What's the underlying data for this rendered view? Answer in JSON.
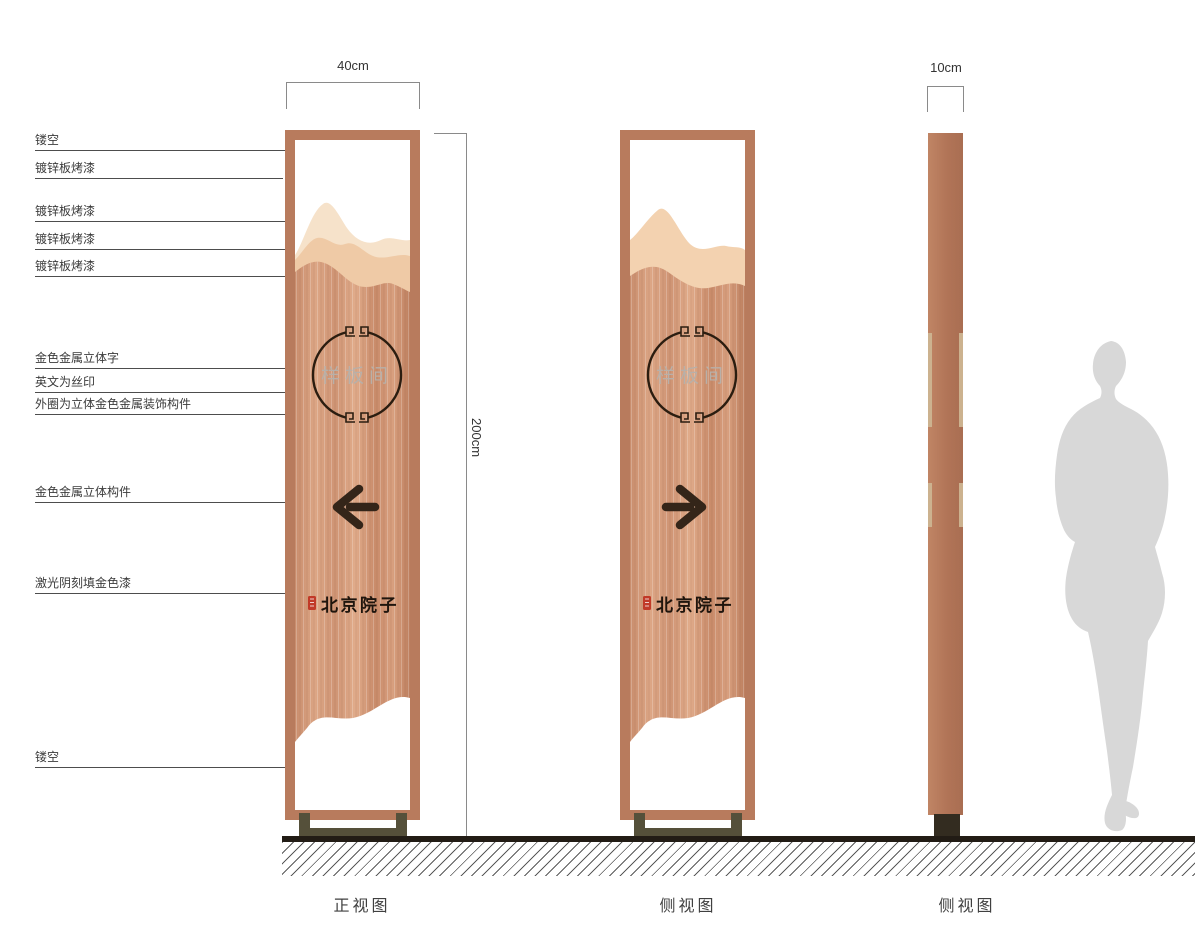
{
  "dimensions": {
    "front_width": "40cm",
    "height": "200cm",
    "side_depth": "10cm"
  },
  "callouts": [
    {
      "label": "镂空"
    },
    {
      "label": "镀锌板烤漆"
    },
    {
      "label": "镀锌板烤漆"
    },
    {
      "label": "镀锌板烤漆"
    },
    {
      "label": "镀锌板烤漆"
    },
    {
      "label": "金色金属立体字"
    },
    {
      "label": "英文为丝印"
    },
    {
      "label": "外圈为立体金色金属装饰构件"
    },
    {
      "label": "金色金属立体构件"
    },
    {
      "label": "激光阴刻填金色漆"
    },
    {
      "label": "镂空"
    }
  ],
  "sign": {
    "plate_text": "样板间",
    "brand_text": "北京院子"
  },
  "views": [
    {
      "label": "正视图"
    },
    {
      "label": "侧视图"
    },
    {
      "label": "侧视图"
    }
  ],
  "icons": {
    "front_arrow": "arrow-left",
    "side_arrow": "arrow-right"
  },
  "colors": {
    "frame_copper": "#b87b5d",
    "panel_copper": "#cf9475",
    "mountain_light": "#f6e2ca",
    "mountain_mid": "#efcaa6",
    "single_mountain": "#f3d2b0",
    "accent_dark": "#342519",
    "plate_text_silver": "#b8b0a9",
    "seal_red": "#c13a28",
    "base_olive": "#55503a",
    "silhouette_gray": "#d8d8d8",
    "ground_black": "#221c15"
  }
}
